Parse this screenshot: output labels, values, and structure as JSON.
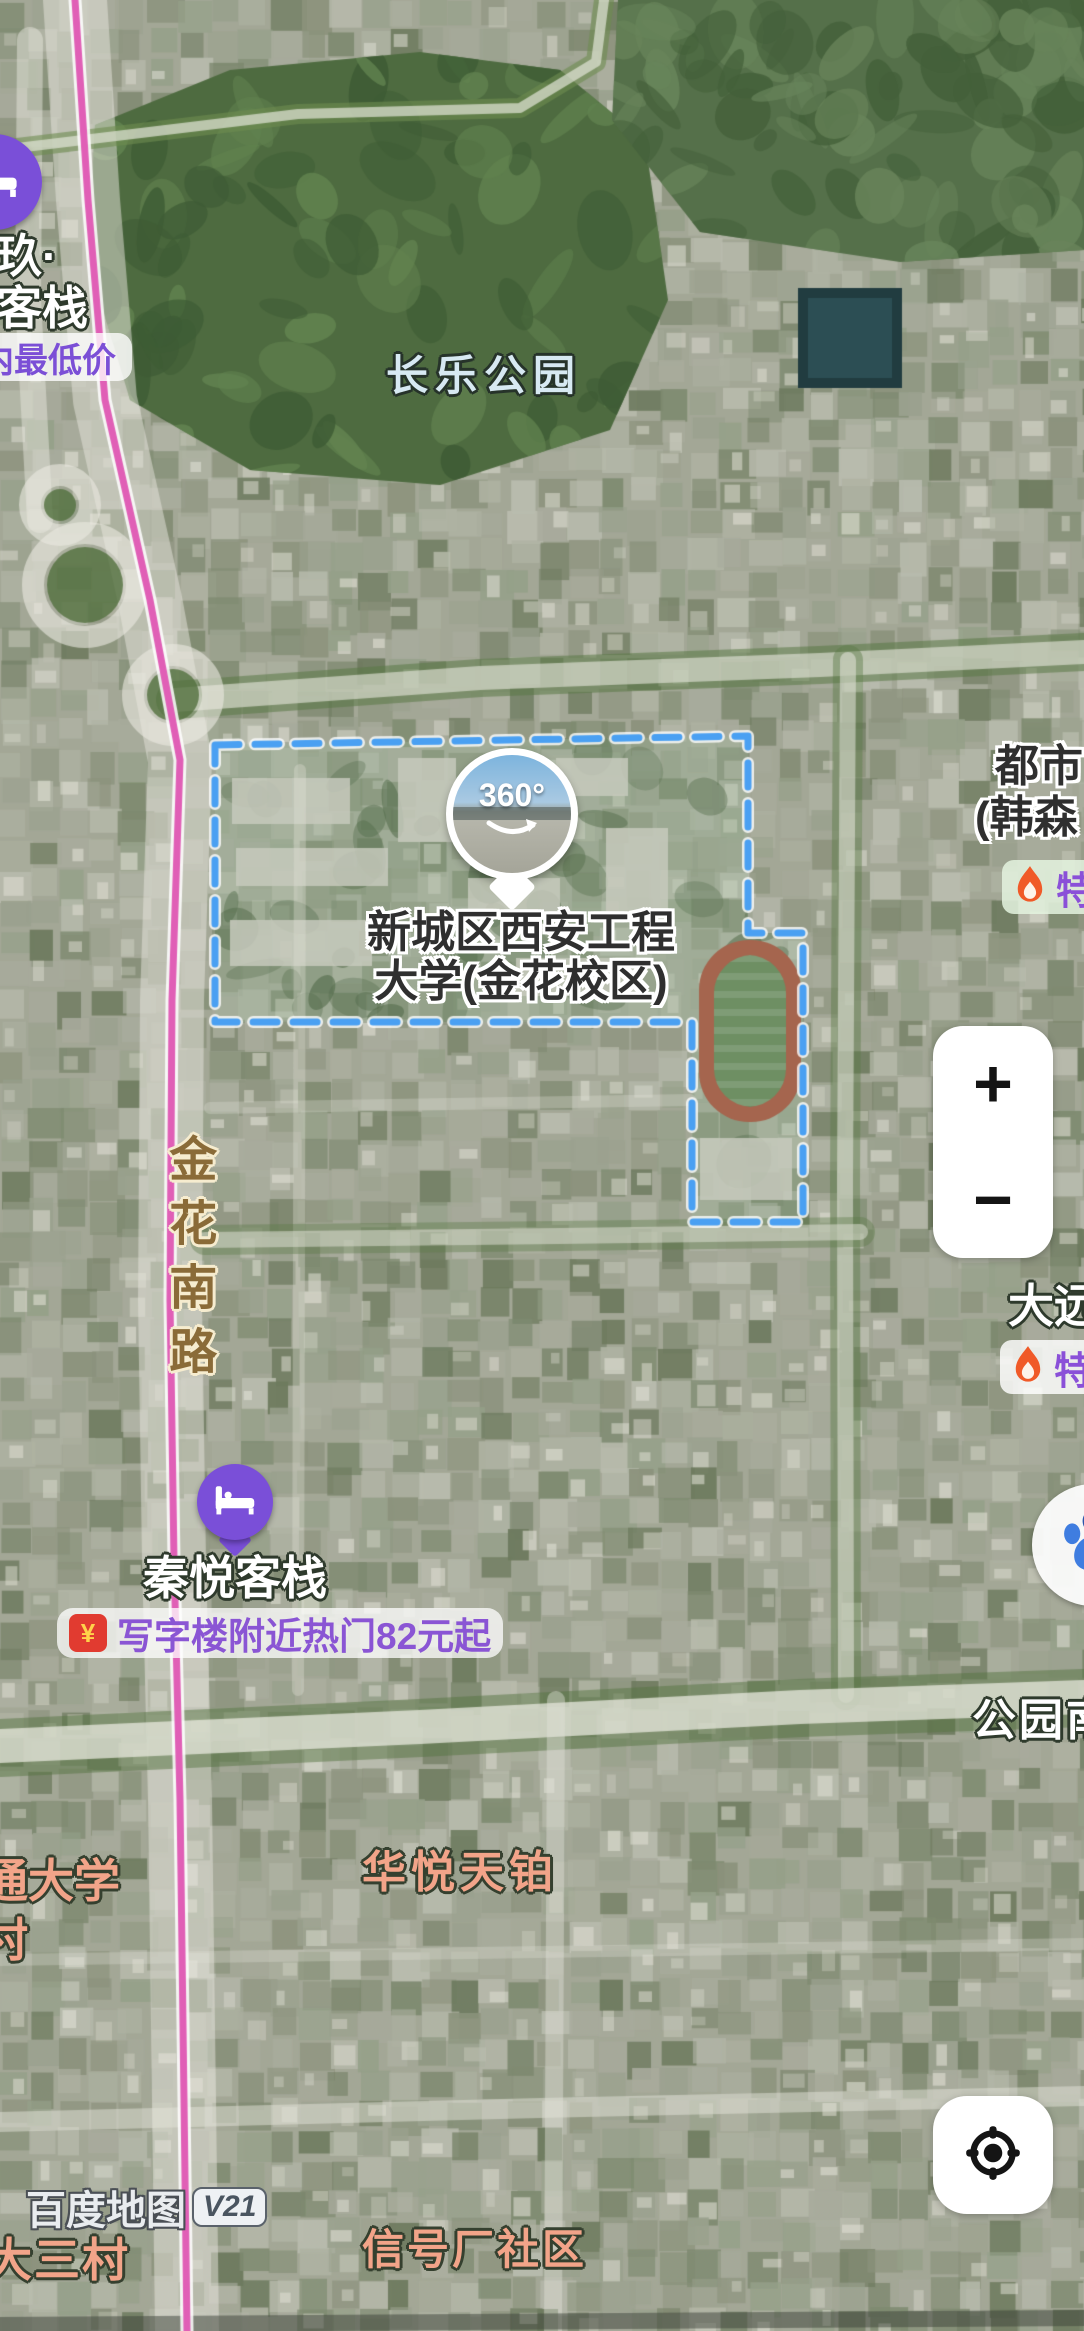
{
  "attribution": {
    "brand": "百度地图",
    "version": "V21"
  },
  "labels": {
    "park": "长乐公园",
    "campus_line1": "新城区西安工程",
    "campus_line2": "大学(金花校区)",
    "road_jinhua": "金花南路",
    "road_gongyuan": "公园南",
    "poi_dushi_line1": "都市",
    "poi_dushi_line2": "(韩森",
    "poi_dayuan": "大远",
    "poi_huayue": "华悦天铂",
    "poi_tong_line1": "通大学",
    "poi_tong_line2": "村",
    "poi_dasancun": "大三村",
    "poi_xinhao": "信号厂社区"
  },
  "markers": {
    "hotel_top": {
      "line1": "玖·",
      "line2": "客栈",
      "badge": "天内最低价"
    },
    "qinyue": {
      "name": "秦悦客栈",
      "badge_text": "写字楼附近热门82元起",
      "badge_icon": "¥"
    },
    "pano": {
      "label": "360°"
    }
  },
  "promo": {
    "te_right": "特",
    "te_dayuan": "特"
  },
  "controls": {
    "zoom_in": "+",
    "zoom_out": "−"
  },
  "colors": {
    "accent_purple": "#7a4fd8",
    "badge_text_purple": "#8a55d4",
    "flame_orange": "#f05a28",
    "route_pink": "#e05fb6",
    "boundary_blue": "#4aa0f2",
    "salmon_label": "#f2a489",
    "road_label_brown": "#8a6b38",
    "park_label_pale": "#d7e9f2"
  },
  "map_features": {
    "size": [
      1084,
      2331
    ],
    "base": "#a3a796",
    "block_palette": [
      "#9aa18e",
      "#8b927c",
      "#aeb2a2",
      "#7e8a70",
      "#b9bcae",
      "#95a089",
      "#6d7a5e",
      "#a8ab9c"
    ],
    "building_color": "rgba(228,227,216,0.6)",
    "parks": [
      {
        "points": [
          [
            95,
            125
          ],
          [
            230,
            70
          ],
          [
            420,
            52
          ],
          [
            560,
            70
          ],
          [
            645,
            140
          ],
          [
            668,
            300
          ],
          [
            610,
            430
          ],
          [
            440,
            485
          ],
          [
            250,
            470
          ],
          [
            130,
            400
          ],
          [
            88,
            260
          ]
        ],
        "color": "#4e6b40",
        "dark": "#3e5c35",
        "light": "#61824f"
      },
      {
        "points": [
          [
            618,
            0
          ],
          [
            1084,
            0
          ],
          [
            1084,
            250
          ],
          [
            900,
            262
          ],
          [
            700,
            232
          ],
          [
            612,
            120
          ]
        ],
        "color": "#55704a",
        "dark": "#44603a",
        "light": "#68845a"
      }
    ],
    "pool": {
      "x": 798,
      "y": 288,
      "w": 104,
      "h": 100,
      "color": "#213c40",
      "inner": "#2c4e54"
    },
    "campus": {
      "points": [
        [
          215,
          745
        ],
        [
          748,
          736
        ],
        [
          748,
          933
        ],
        [
          803,
          933
        ],
        [
          803,
          1222
        ],
        [
          692,
          1222
        ],
        [
          692,
          1022
        ],
        [
          215,
          1022
        ]
      ],
      "fill": "rgba(120,150,110,0.28)",
      "haze": "rgba(230,235,230,0.14)",
      "tree": "rgba(56,84,46,0.65)",
      "stroke": "#4aa0f2",
      "dash": [
        24,
        16
      ],
      "width": 7
    },
    "campus_buildings": [
      [
        232,
        778,
        118,
        46
      ],
      [
        236,
        848,
        152,
        38
      ],
      [
        230,
        920,
        142,
        46
      ],
      [
        398,
        758,
        58,
        84
      ],
      [
        468,
        878,
        92,
        40
      ],
      [
        556,
        758,
        72,
        38
      ],
      [
        606,
        828,
        62,
        92
      ],
      [
        516,
        958,
        122,
        38
      ],
      [
        700,
        1138,
        92,
        62
      ]
    ],
    "stadium": {
      "x": 699,
      "y": 940,
      "w": 102,
      "h": 182,
      "r": 50,
      "track": "#a5654e",
      "pad": 15,
      "field": "#6e8f63"
    },
    "roads": [
      {
        "pts": [
          [
            75,
            0
          ],
          [
            88,
            200
          ],
          [
            105,
            400
          ],
          [
            150,
            600
          ],
          [
            180,
            760
          ],
          [
            172,
            1000
          ],
          [
            170,
            1300
          ],
          [
            174,
            1560
          ],
          [
            180,
            1800
          ],
          [
            184,
            2100
          ],
          [
            187,
            2331
          ]
        ],
        "w": 64,
        "c": "rgba(232,230,222,0.5)"
      },
      {
        "pts": [
          [
            30,
            40
          ],
          [
            28,
            300
          ],
          [
            40,
            520
          ]
        ],
        "w": 26,
        "c": "rgba(230,230,220,0.5)"
      },
      {
        "pts": [
          [
            0,
            150
          ],
          [
            298,
            114
          ],
          [
            520,
            108
          ],
          [
            596,
            62
          ],
          [
            604,
            0
          ]
        ],
        "w": 20,
        "c": "rgba(110,140,80,0.6)"
      },
      {
        "pts": [
          [
            0,
            150
          ],
          [
            298,
            114
          ],
          [
            520,
            108
          ],
          [
            596,
            62
          ],
          [
            604,
            0
          ]
        ],
        "w": 10,
        "c": "rgba(225,228,215,0.7)"
      },
      {
        "pts": [
          [
            175,
            700
          ],
          [
            480,
            678
          ],
          [
            820,
            665
          ],
          [
            1084,
            652
          ]
        ],
        "w": 38,
        "c": "rgba(90,120,70,0.55)"
      },
      {
        "pts": [
          [
            175,
            700
          ],
          [
            480,
            678
          ],
          [
            820,
            665
          ],
          [
            1084,
            652
          ]
        ],
        "w": 24,
        "c": "rgba(232,232,222,0.6)"
      },
      {
        "pts": [
          [
            848,
            660
          ],
          [
            845,
            1180
          ],
          [
            846,
            1695
          ]
        ],
        "w": 30,
        "c": "rgba(92,122,72,0.45)"
      },
      {
        "pts": [
          [
            848,
            660
          ],
          [
            845,
            1180
          ],
          [
            846,
            1695
          ]
        ],
        "w": 16,
        "c": "rgba(230,230,220,0.55)"
      },
      {
        "pts": [
          [
            300,
            770
          ],
          [
            298,
            1690
          ]
        ],
        "w": 12,
        "c": "rgba(225,225,215,0.35)"
      },
      {
        "pts": [
          [
            210,
            1108
          ],
          [
            690,
            1100
          ]
        ],
        "w": 12,
        "c": "rgba(225,225,215,0.3)"
      },
      {
        "pts": [
          [
            205,
            1240
          ],
          [
            560,
            1236
          ],
          [
            860,
            1232
          ]
        ],
        "w": 30,
        "c": "rgba(92,122,72,0.4)"
      },
      {
        "pts": [
          [
            205,
            1240
          ],
          [
            560,
            1236
          ],
          [
            860,
            1232
          ]
        ],
        "w": 16,
        "c": "rgba(228,228,218,0.5)"
      },
      {
        "pts": [
          [
            0,
            1748
          ],
          [
            420,
            1728
          ],
          [
            800,
            1708
          ],
          [
            1084,
            1698
          ]
        ],
        "w": 58,
        "c": "rgba(86,116,66,0.5)"
      },
      {
        "pts": [
          [
            0,
            1746
          ],
          [
            420,
            1727
          ],
          [
            800,
            1707
          ],
          [
            1084,
            1697
          ]
        ],
        "w": 34,
        "c": "rgba(235,235,226,0.72)"
      },
      {
        "pts": [
          [
            556,
            1700
          ],
          [
            553,
            2331
          ]
        ],
        "w": 18,
        "c": "rgba(225,225,215,0.45)"
      },
      {
        "pts": [
          [
            0,
            1960
          ],
          [
            540,
            1952
          ],
          [
            1084,
            1944
          ]
        ],
        "w": 12,
        "c": "rgba(225,225,215,0.3)"
      },
      {
        "pts": [
          [
            0,
            2122
          ],
          [
            540,
            2108
          ],
          [
            1084,
            2096
          ]
        ],
        "w": 20,
        "c": "rgba(228,228,218,0.5)"
      },
      {
        "pts": [
          [
            0,
            2325
          ],
          [
            1084,
            2318
          ]
        ],
        "w": 16,
        "c": "rgba(60,65,55,0.5)"
      }
    ],
    "roundabouts": [
      {
        "c": [
          85,
          585
        ],
        "r": 52
      },
      {
        "c": [
          173,
          695
        ],
        "r": 40
      },
      {
        "c": [
          60,
          505
        ],
        "r": 30
      }
    ],
    "ring_style": {
      "w": 22,
      "c": "rgba(235,233,225,0.6)",
      "inner": "#52703f"
    },
    "pink_route": {
      "pts": [
        [
          75,
          0
        ],
        [
          88,
          200
        ],
        [
          105,
          400
        ],
        [
          150,
          600
        ],
        [
          180,
          760
        ],
        [
          172,
          1000
        ],
        [
          170,
          1300
        ],
        [
          174,
          1560
        ],
        [
          180,
          1800
        ],
        [
          184,
          2100
        ],
        [
          187,
          2331
        ]
      ],
      "w": 7,
      "c": "#e05fb6",
      "case_w": 13,
      "case_c": "rgba(255,255,255,0.85)"
    }
  }
}
